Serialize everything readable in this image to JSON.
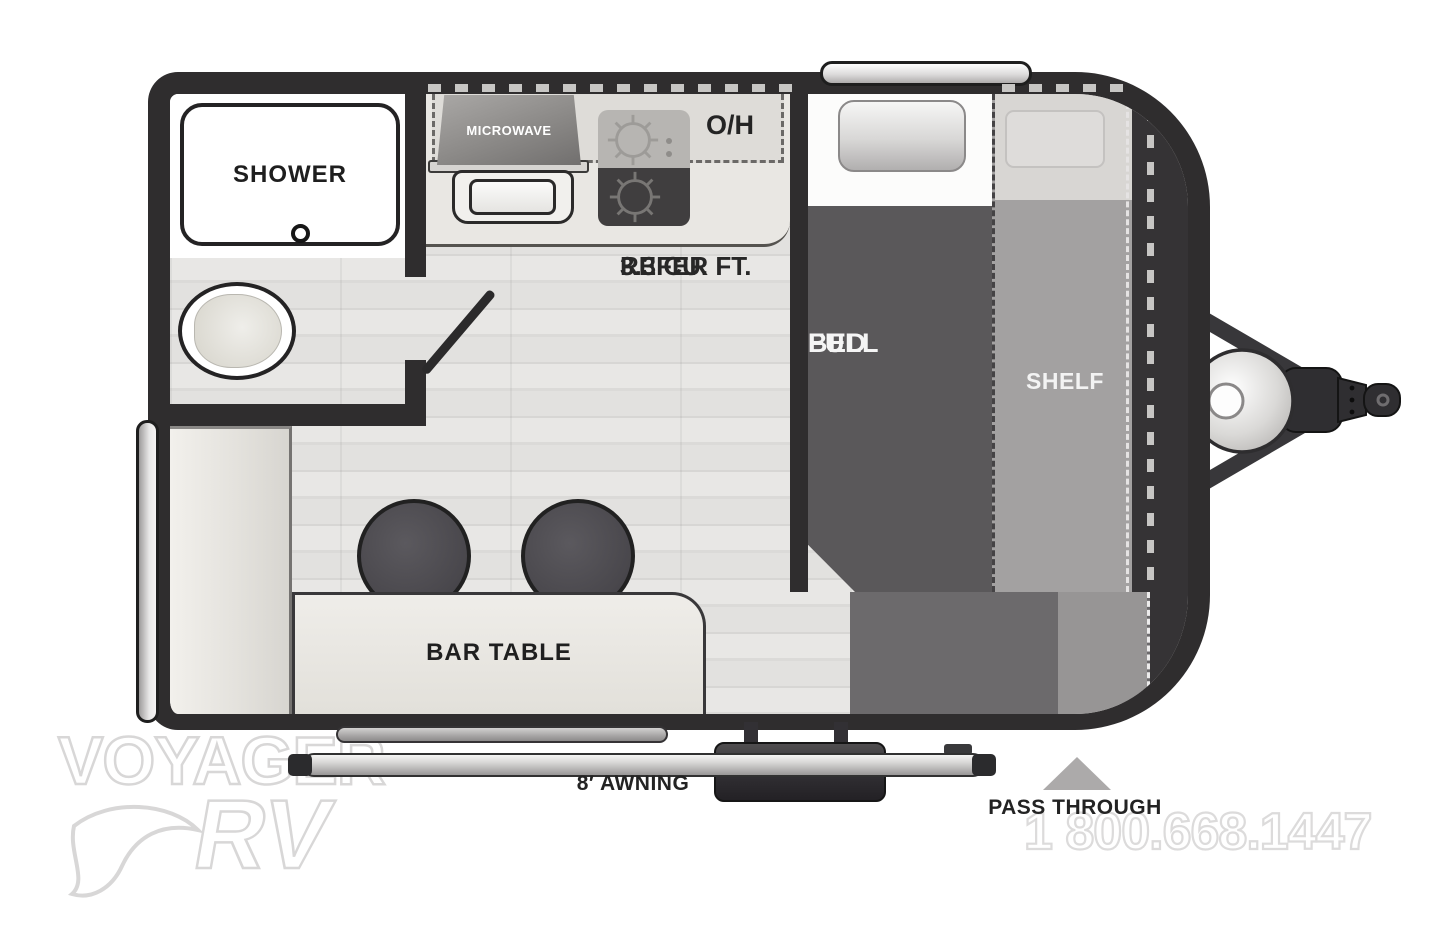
{
  "plan": {
    "bathroom": {
      "shower_label": "SHOWER"
    },
    "kitchen": {
      "microwave_label": "MICROWAVE",
      "overhead_label": "O/H",
      "refer_line1": "3.3 CU. FT.",
      "refer_line2": "REFER"
    },
    "bedroom": {
      "bed_line1": "FULL",
      "bed_line2": "BED",
      "shelf_label": "SHELF"
    },
    "dinette": {
      "bar_table_label": "BAR TABLE"
    },
    "exterior": {
      "awning_label": "8′ AWNING",
      "pass_through_label": "PASS THROUGH"
    }
  },
  "watermark": {
    "brand_top": "VOYAGER",
    "brand_bottom": "RV",
    "phone": "1 800.668.1447"
  },
  "colors": {
    "wall": "#2f2d2e",
    "floor_light": "#e8e7e5",
    "bed_dark": "#5a585a",
    "shelf_gray": "#a3a1a1",
    "counter": "#e9e7e3"
  }
}
